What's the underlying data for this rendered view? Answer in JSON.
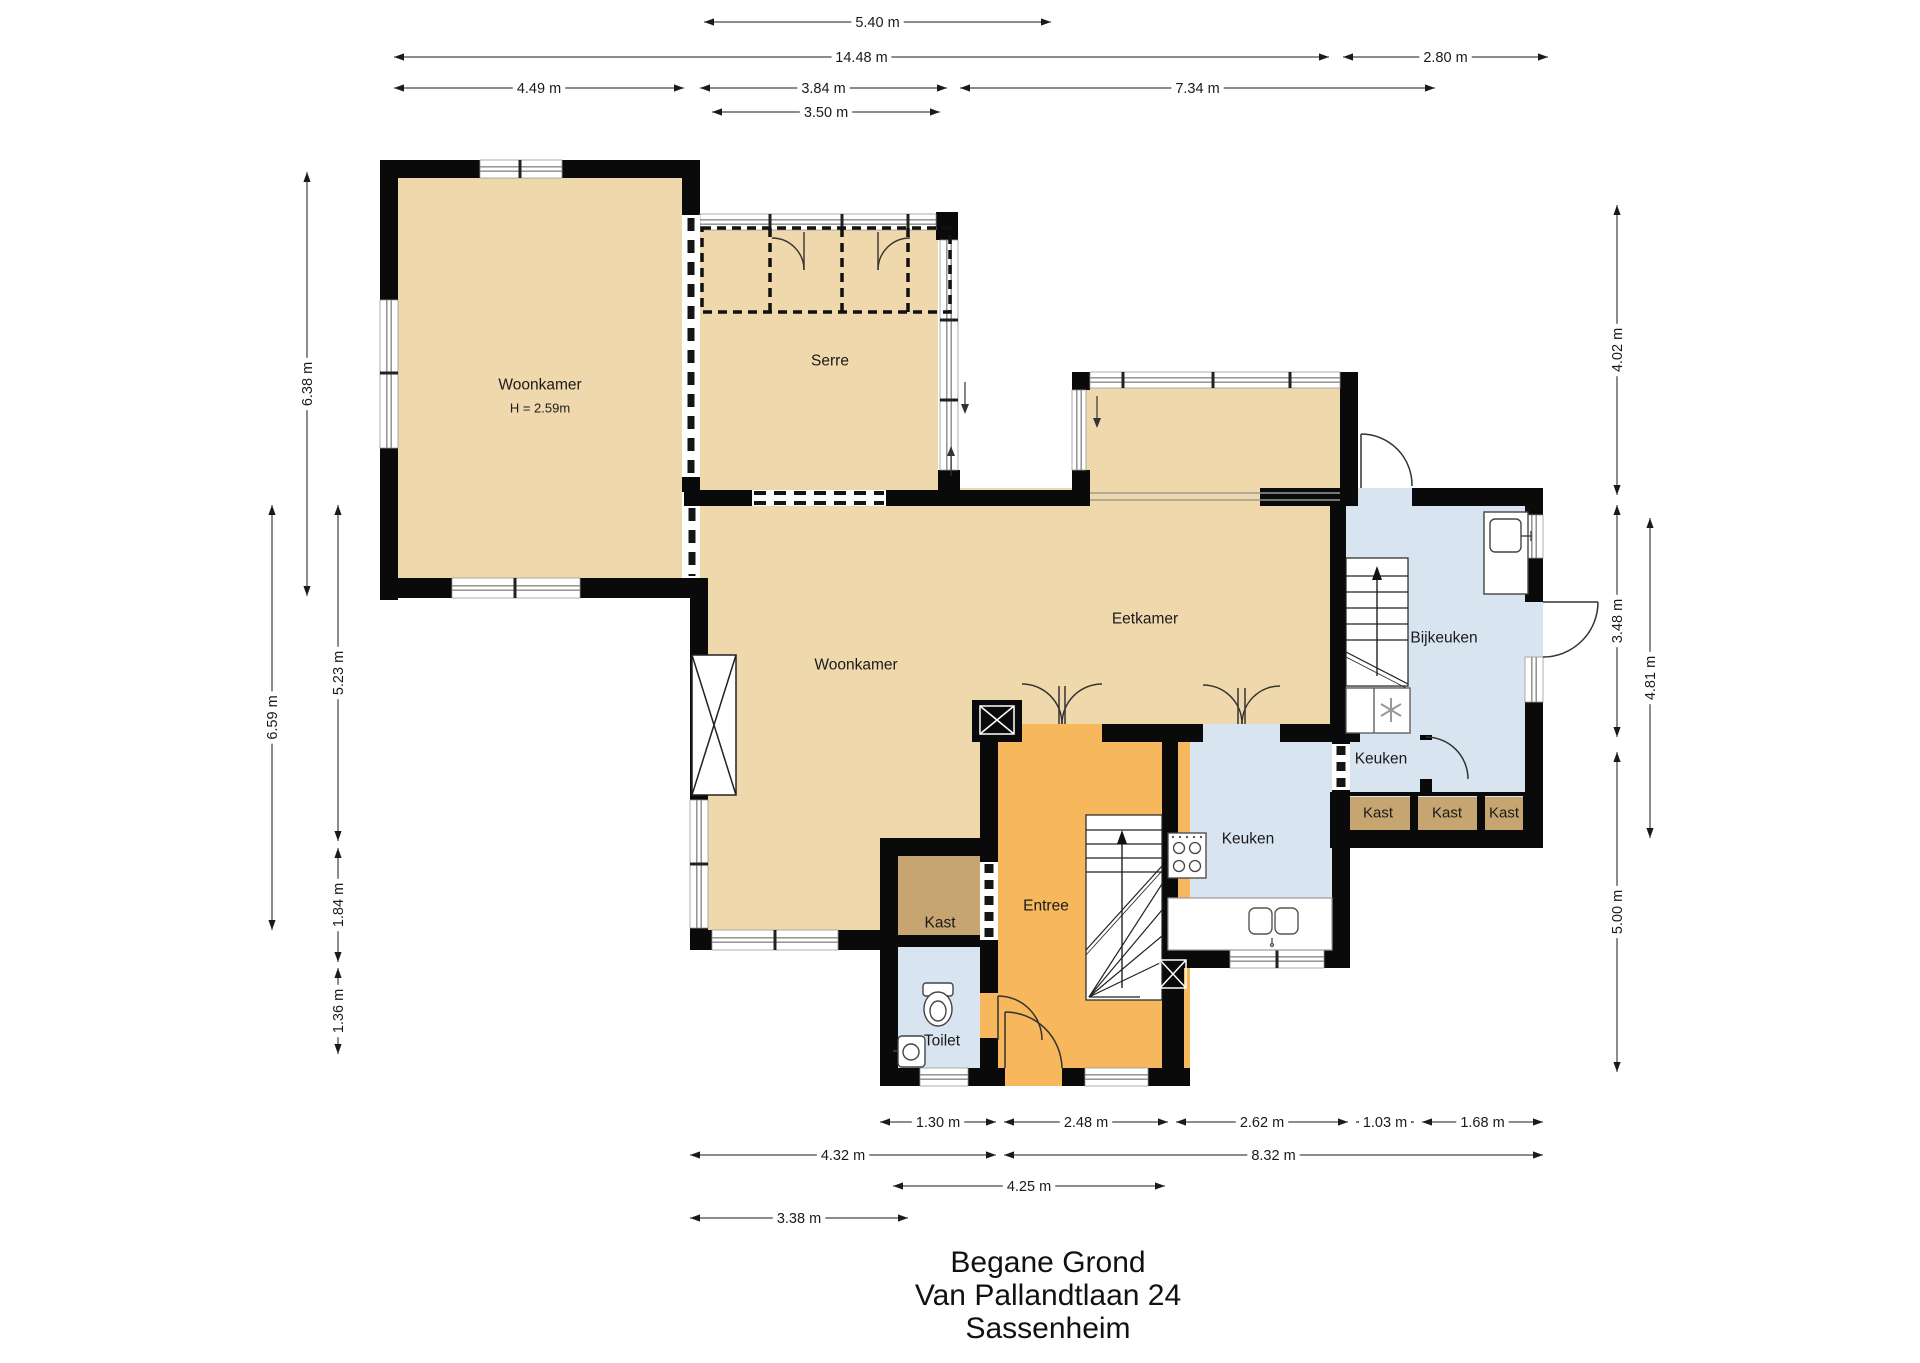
{
  "plan_title": {
    "line1": "Begane Grond",
    "line2": "Van Pallandtlaan 24",
    "line3": "Sassenheim"
  },
  "rooms": [
    {
      "id": "woonkamer-voor",
      "label": "Woonkamer",
      "height_note": "H = 2.59m"
    },
    {
      "id": "serre",
      "label": "Serre"
    },
    {
      "id": "woonkamer-main",
      "label": "Woonkamer"
    },
    {
      "id": "eetkamer",
      "label": "Eetkamer"
    },
    {
      "id": "bijkeuken",
      "label": "Bijkeuken"
    },
    {
      "id": "keuken-main",
      "label": "Keuken"
    },
    {
      "id": "keuken-small",
      "label": "Keuken"
    },
    {
      "id": "entree",
      "label": "Entree"
    },
    {
      "id": "kast-hal",
      "label": "Kast"
    },
    {
      "id": "toilet",
      "label": "Toilet"
    },
    {
      "id": "kast-1",
      "label": "Kast"
    },
    {
      "id": "kast-2",
      "label": "Kast"
    },
    {
      "id": "kast-3",
      "label": "Kast"
    }
  ],
  "dimensions": [
    {
      "id": "top-5-40",
      "label": "5.40 m"
    },
    {
      "id": "top-14-48",
      "label": "14.48 m"
    },
    {
      "id": "top-2-80",
      "label": "2.80 m"
    },
    {
      "id": "top-4-49",
      "label": "4.49 m"
    },
    {
      "id": "top-3-84",
      "label": "3.84 m"
    },
    {
      "id": "top-7-34",
      "label": "7.34 m"
    },
    {
      "id": "top-3-50",
      "label": "3.50 m"
    },
    {
      "id": "left-6-38",
      "label": "6.38 m"
    },
    {
      "id": "left-6-59",
      "label": "6.59 m"
    },
    {
      "id": "left-5-23",
      "label": "5.23 m"
    },
    {
      "id": "left-1-84",
      "label": "1.84 m"
    },
    {
      "id": "left-1-36",
      "label": "1.36 m"
    },
    {
      "id": "right-4-02",
      "label": "4.02 m"
    },
    {
      "id": "right-3-48",
      "label": "3.48 m"
    },
    {
      "id": "right-4-81",
      "label": "4.81 m"
    },
    {
      "id": "right-5-00",
      "label": "5.00 m"
    },
    {
      "id": "bottom-1-30",
      "label": "1.30 m"
    },
    {
      "id": "bottom-2-48",
      "label": "2.48 m"
    },
    {
      "id": "bottom-2-62",
      "label": "2.62 m"
    },
    {
      "id": "bottom-1-03",
      "label": "1.03 m"
    },
    {
      "id": "bottom-1-68",
      "label": "1.68 m"
    },
    {
      "id": "bottom-4-32",
      "label": "4.32 m"
    },
    {
      "id": "bottom-8-32",
      "label": "8.32 m"
    },
    {
      "id": "bottom-4-25",
      "label": "4.25 m"
    },
    {
      "id": "bottom-3-38",
      "label": "3.38 m"
    }
  ],
  "colors": {
    "floor_tan": "#EFD8AC",
    "floor_orange": "#F6B75D",
    "floor_blue": "#D9E4F1",
    "closet_brown": "#C7A571",
    "wall_black": "#0A0A0A",
    "window_gray": "#8A8A8A",
    "dim_text": "#1A1A1A"
  }
}
